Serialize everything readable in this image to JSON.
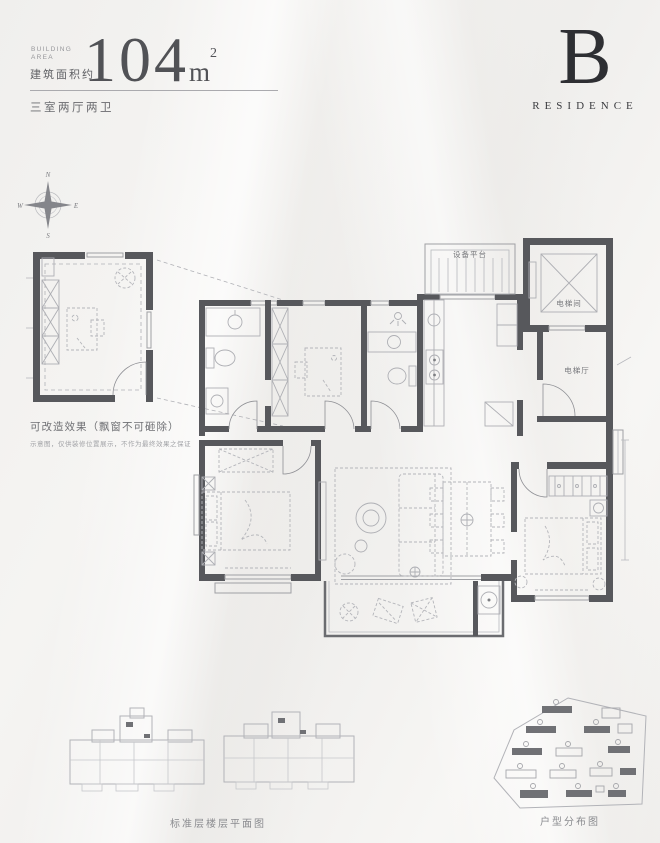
{
  "header": {
    "building_label_line1": "BUILDING",
    "building_label_line2": "AREA",
    "area_prefix_cn": "建筑面积约",
    "area_value": "104",
    "area_unit": "m",
    "area_exp": "2",
    "layout_type": "三室两厅两卫"
  },
  "logo": {
    "initial": "B",
    "brand": "RESIDENCE"
  },
  "compass": {
    "north": "N",
    "south": "S",
    "east": "E",
    "west": "W"
  },
  "annex_note": {
    "title": "可改造效果（飘窗不可砸除）",
    "disclaimer": "示意图，仅供装修位置展示，不作为最终效果之保证"
  },
  "floorplan": {
    "labels": {
      "equipment_platform": "设备平台",
      "elevator_shaft": "电梯间",
      "elevator_hall": "电梯厅"
    }
  },
  "captions": {
    "standard_floor_plan": "标准层楼层平面图",
    "unit_distribution": "户型分布图"
  },
  "colors": {
    "wall": "#57585c",
    "ink": "#515256",
    "line": "#9fa0a4"
  }
}
